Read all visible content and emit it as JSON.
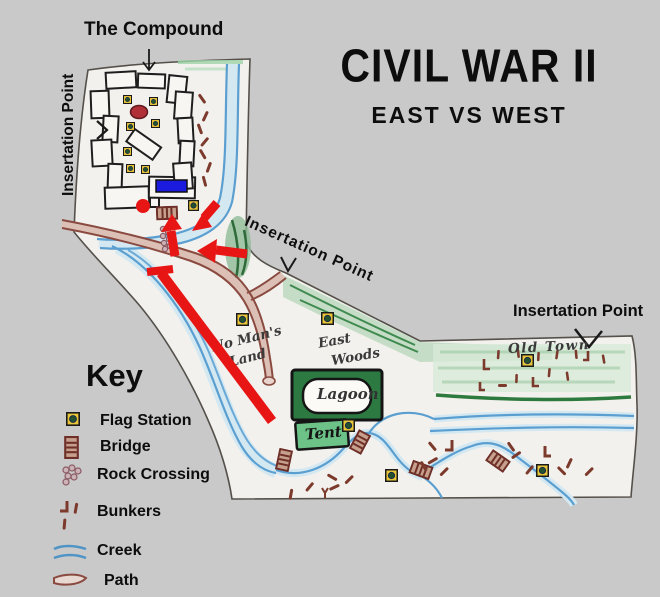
{
  "title": {
    "main": "CIVIL WAR II",
    "subtitle": "EAST VS WEST"
  },
  "annotations": {
    "compound_label": "The Compound",
    "insertion_west": "Insertation Point",
    "insertion_center": "Insertation Point",
    "insertion_east": "Insertation Point"
  },
  "key": {
    "heading": "Key",
    "items": [
      {
        "id": "flag-station",
        "label": "Flag Station"
      },
      {
        "id": "bridge",
        "label": "Bridge"
      },
      {
        "id": "rock-crossing",
        "label": "Rock Crossing"
      },
      {
        "id": "bunkers",
        "label": "Bunkers"
      },
      {
        "id": "creek",
        "label": "Creek"
      },
      {
        "id": "path",
        "label": "Path"
      }
    ]
  },
  "map_labels": {
    "no_mans_land_line1": "No Man's",
    "no_mans_land_line2": "Land",
    "east_woods_line1": "East",
    "east_woods_line2": "Woods",
    "lagoon": "Lagoon",
    "tent": "Tent",
    "old_town": "Old Town"
  },
  "colors": {
    "background": "#c9c9c9",
    "paper": "#f2f1ed",
    "annotation_red": "#e81515",
    "marker_blue": "#1b1be0",
    "creek_blue": "#5b9fd0",
    "path_brown": "#8a4a40",
    "woods_green": "#3f8a4f",
    "flag_yellow": "#e9c53a"
  }
}
